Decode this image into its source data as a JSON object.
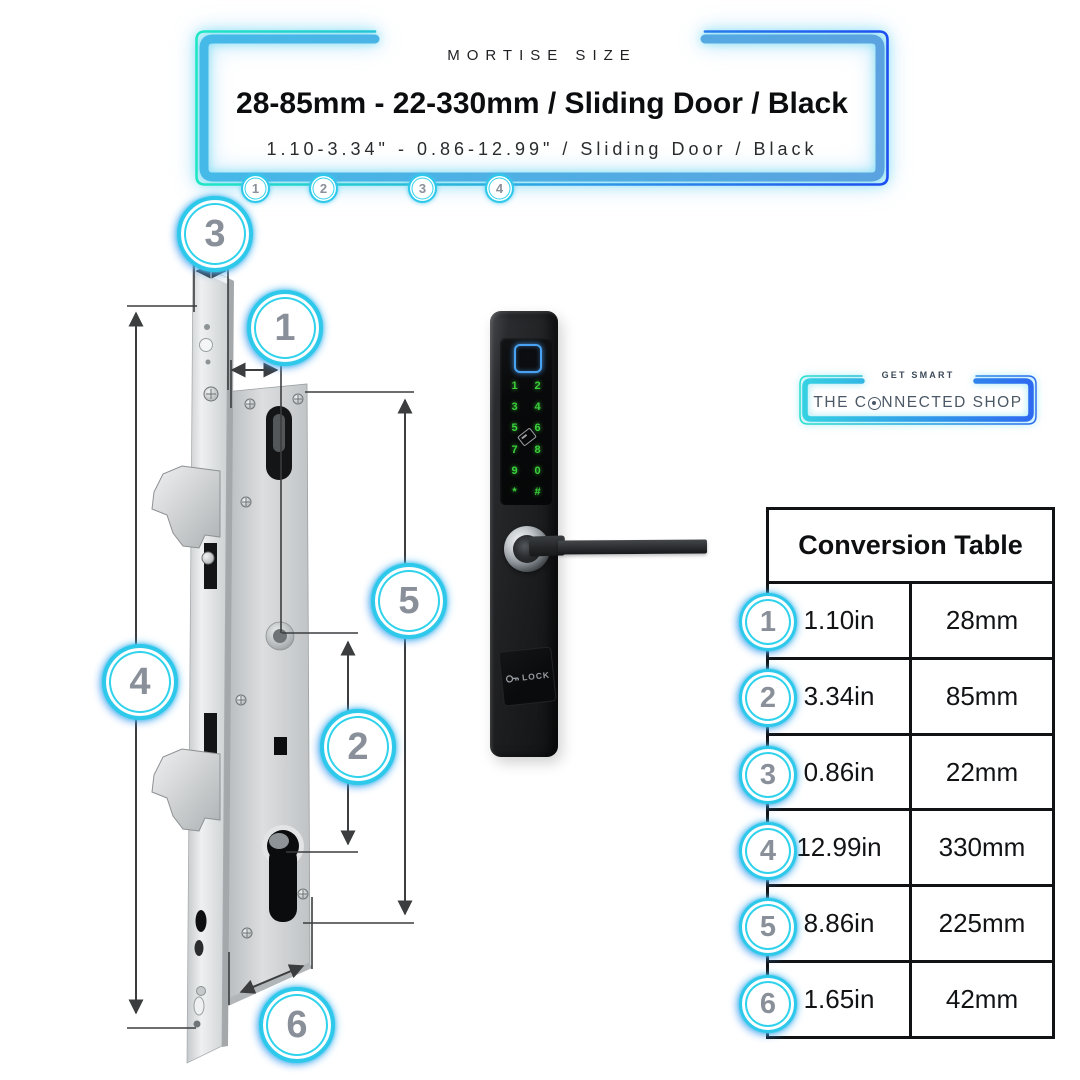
{
  "header": {
    "eyebrow": "MORTISE SIZE",
    "title": "28-85mm - 22-330mm / Sliding Door / Black",
    "subtitle": "1.10-3.34\" - 0.86-12.99\" / Sliding Door / Black",
    "ticks": [
      "1",
      "2",
      "3",
      "4"
    ]
  },
  "diagram": {
    "callouts": {
      "c1": "1",
      "c2": "2",
      "c3": "3",
      "c4": "4",
      "c5": "5",
      "c6": "6"
    }
  },
  "lock": {
    "keypad": [
      "1",
      "2",
      "3",
      "4",
      "5",
      "6",
      "7",
      "8",
      "9",
      "0",
      "*",
      "#"
    ],
    "panel_label": "LOCK"
  },
  "brand": {
    "tagline": "GET SMART",
    "name": "THE CONNECTED SHOP",
    "name_part1": "THE C",
    "name_part2": "NNECTED SHOP"
  },
  "conversion_table": {
    "title": "Conversion Table",
    "rows": [
      {
        "num": "1",
        "inches": "1.10in",
        "mm": "28mm"
      },
      {
        "num": "2",
        "inches": "3.34in",
        "mm": "85mm"
      },
      {
        "num": "3",
        "inches": "0.86in",
        "mm": "22mm"
      },
      {
        "num": "4",
        "inches": "12.99in",
        "mm": "330mm"
      },
      {
        "num": "5",
        "inches": "8.86in",
        "mm": "225mm"
      },
      {
        "num": "6",
        "inches": "1.65in",
        "mm": "42mm"
      }
    ]
  },
  "colors": {
    "neon_mint": "#1fe7c4",
    "neon_blue": "#1c4ef0",
    "steel_blue": "#56a9e8",
    "ring_cyan": "#2ec9ea",
    "badge_number_gray": "#8a9099",
    "keypad_green": "#3ad13a",
    "fingerprint_blue": "#4aa2f2",
    "table_border": "#111213"
  },
  "icons": {
    "wifi_o_icon": "circle with center dot (brand O)",
    "rfid_card_icon": "tilted card outline on keypad",
    "key_icon": "key glyph beside LOCK label",
    "arrowheads": "measurement double arrows"
  }
}
